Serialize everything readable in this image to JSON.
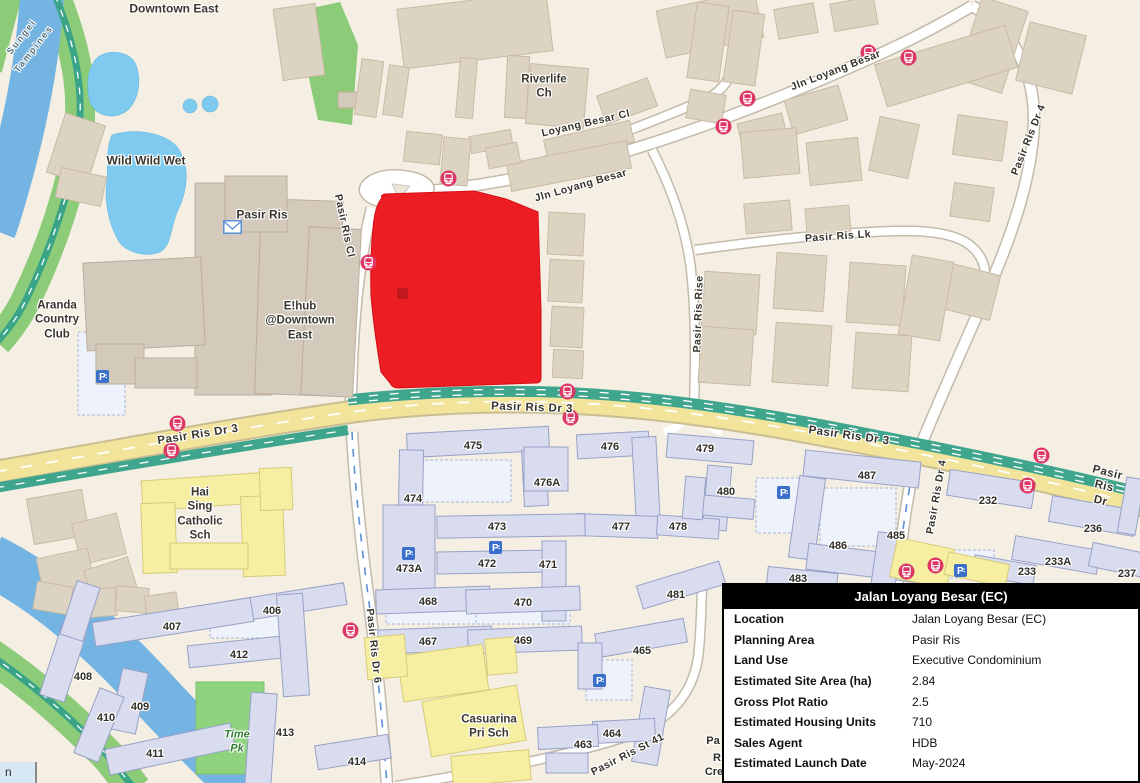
{
  "info_panel": {
    "title": "Jalan Loyang Besar (EC)",
    "rows": [
      {
        "label": "Location",
        "value": "Jalan Loyang Besar (EC)"
      },
      {
        "label": "Planning Area",
        "value": "Pasir Ris"
      },
      {
        "label": "Land Use",
        "value": "Executive Condominium"
      },
      {
        "label": "Estimated Site Area (ha)",
        "value": "2.84"
      },
      {
        "label": "Gross Plot Ratio",
        "value": "2.5"
      },
      {
        "label": "Estimated Housing Units",
        "value": "710"
      },
      {
        "label": "Sales Agent",
        "value": "HDB"
      },
      {
        "label": "Estimated Launch Date",
        "value": "May-2024"
      }
    ]
  },
  "map": {
    "attribution_fragment": "n",
    "colors": {
      "highlight_plot": "#ec1d23",
      "road_major": "#f3e49b",
      "cycle_path": "#3fa58d",
      "water": "#74b4e3",
      "park": "#8ccb77",
      "hdb_block": "#d8dcee",
      "school": "#f6efa2",
      "bus_icon": "#dd3766",
      "parking_icon": "#3a70c9"
    },
    "labels": [
      {
        "text": "Downtown East",
        "x": 174,
        "y": 9,
        "rot": 0,
        "cls": "place"
      },
      {
        "text": "Sungei",
        "x": 22,
        "y": 37,
        "rot": -52,
        "cls": "water",
        "size": 9
      },
      {
        "text": "Tampines",
        "x": 34,
        "y": 49,
        "rot": -52,
        "cls": "water",
        "size": 9
      },
      {
        "text": "Wild Wild Wet",
        "x": 146,
        "y": 161,
        "rot": 0,
        "cls": "place"
      },
      {
        "text": "Pasir Ris",
        "x": 262,
        "y": 215,
        "rot": 0,
        "cls": "place"
      },
      {
        "text": "Aranda\nCountry\nClub",
        "x": 57,
        "y": 320,
        "rot": 0,
        "cls": "place",
        "size": 11.5
      },
      {
        "text": "E!hub\n@Downtown\nEast",
        "x": 300,
        "y": 321,
        "rot": 0,
        "cls": "place",
        "size": 11.5
      },
      {
        "text": "Riverlife\nCh",
        "x": 544,
        "y": 87,
        "rot": 0,
        "cls": "place",
        "size": 11.5
      },
      {
        "text": "Hai\nSing\nCatholic\nSch",
        "x": 200,
        "y": 514,
        "rot": 0,
        "cls": "place",
        "size": 11.5
      },
      {
        "text": "Casuarina\nPri Sch",
        "x": 489,
        "y": 727,
        "rot": 0,
        "cls": "place",
        "size": 11.5
      },
      {
        "text": "Time\nPk",
        "x": 237,
        "y": 742,
        "rot": 0,
        "cls": "park",
        "size": 11
      },
      {
        "text": "Loyang Besar Cl",
        "x": 586,
        "y": 124,
        "rot": -13,
        "cls": "street"
      },
      {
        "text": "Jln Loyang Besar",
        "x": 581,
        "y": 186,
        "rot": -16,
        "cls": "street"
      },
      {
        "text": "Jln Loyang Besar",
        "x": 836,
        "y": 71,
        "rot": -21,
        "cls": "street"
      },
      {
        "text": "Pasir Ris Lk",
        "x": 838,
        "y": 237,
        "rot": -4,
        "cls": "street"
      },
      {
        "text": "Pasir Ris Rise",
        "x": 699,
        "y": 314,
        "rot": -88,
        "cls": "street"
      },
      {
        "text": "Pasir Ris Dr 4",
        "x": 1029,
        "y": 140,
        "rot": -68,
        "cls": "street"
      },
      {
        "text": "Pasir Ris Dr 4",
        "x": 937,
        "y": 497,
        "rot": -80,
        "cls": "street"
      },
      {
        "text": "Pasir Ris Cl",
        "x": 344,
        "y": 226,
        "rot": 78,
        "cls": "street"
      },
      {
        "text": "Pasir Ris Dr 3",
        "x": 198,
        "y": 435,
        "rot": -9,
        "cls": "street",
        "size": 11.5
      },
      {
        "text": "Pasir Ris Dr 3",
        "x": 532,
        "y": 408,
        "rot": 2,
        "cls": "street",
        "size": 11.5
      },
      {
        "text": "Pasir Ris Dr 3",
        "x": 849,
        "y": 436,
        "rot": 8,
        "cls": "street",
        "size": 11.5
      },
      {
        "text": "Pasir Ris Dr",
        "x": 1104,
        "y": 487,
        "rot": 14,
        "cls": "street",
        "size": 11.5
      },
      {
        "text": "Pasir Ris Dr 6",
        "x": 373,
        "y": 646,
        "rot": 84,
        "cls": "street"
      },
      {
        "text": "Pasir Ris St 41",
        "x": 628,
        "y": 755,
        "rot": -27,
        "cls": "street"
      },
      {
        "text": "475",
        "x": 473,
        "y": 447,
        "cls": "block"
      },
      {
        "text": "476",
        "x": 610,
        "y": 448,
        "cls": "block"
      },
      {
        "text": "479",
        "x": 705,
        "y": 450,
        "cls": "block"
      },
      {
        "text": "474",
        "x": 413,
        "y": 500,
        "cls": "block"
      },
      {
        "text": "476A",
        "x": 547,
        "y": 484,
        "cls": "block"
      },
      {
        "text": "473",
        "x": 497,
        "y": 528,
        "cls": "block"
      },
      {
        "text": "477",
        "x": 621,
        "y": 528,
        "cls": "block"
      },
      {
        "text": "478",
        "x": 678,
        "y": 528,
        "cls": "block"
      },
      {
        "text": "480",
        "x": 726,
        "y": 493,
        "cls": "block"
      },
      {
        "text": "487",
        "x": 867,
        "y": 477,
        "cls": "block"
      },
      {
        "text": "473A",
        "x": 409,
        "y": 570,
        "cls": "block"
      },
      {
        "text": "472",
        "x": 487,
        "y": 565,
        "cls": "block"
      },
      {
        "text": "471",
        "x": 548,
        "y": 566,
        "cls": "block"
      },
      {
        "text": "486",
        "x": 838,
        "y": 547,
        "cls": "block"
      },
      {
        "text": "485",
        "x": 896,
        "y": 537,
        "cls": "block"
      },
      {
        "text": "232",
        "x": 988,
        "y": 502,
        "cls": "block"
      },
      {
        "text": "236",
        "x": 1093,
        "y": 530,
        "cls": "block"
      },
      {
        "text": "233A",
        "x": 1058,
        "y": 563,
        "cls": "block"
      },
      {
        "text": "233",
        "x": 1027,
        "y": 573,
        "cls": "block"
      },
      {
        "text": "237",
        "x": 1127,
        "y": 575,
        "cls": "block"
      },
      {
        "text": "483",
        "x": 798,
        "y": 580,
        "cls": "block"
      },
      {
        "text": "468",
        "x": 428,
        "y": 603,
        "cls": "block"
      },
      {
        "text": "470",
        "x": 523,
        "y": 604,
        "cls": "block"
      },
      {
        "text": "481",
        "x": 676,
        "y": 596,
        "cls": "block"
      },
      {
        "text": "467",
        "x": 428,
        "y": 643,
        "cls": "block"
      },
      {
        "text": "469",
        "x": 523,
        "y": 642,
        "cls": "block"
      },
      {
        "text": "465",
        "x": 642,
        "y": 652,
        "cls": "block"
      },
      {
        "text": "406",
        "x": 272,
        "y": 612,
        "cls": "block"
      },
      {
        "text": "407",
        "x": 172,
        "y": 628,
        "cls": "block"
      },
      {
        "text": "412",
        "x": 239,
        "y": 656,
        "cls": "block"
      },
      {
        "text": "408",
        "x": 83,
        "y": 678,
        "cls": "block"
      },
      {
        "text": "409",
        "x": 140,
        "y": 708,
        "cls": "block"
      },
      {
        "text": "410",
        "x": 106,
        "y": 719,
        "cls": "block"
      },
      {
        "text": "411",
        "x": 155,
        "y": 755,
        "cls": "block"
      },
      {
        "text": "413",
        "x": 285,
        "y": 734,
        "cls": "block"
      },
      {
        "text": "414",
        "x": 357,
        "y": 763,
        "cls": "block"
      },
      {
        "text": "464",
        "x": 612,
        "y": 735,
        "cls": "block"
      },
      {
        "text": "463",
        "x": 583,
        "y": 746,
        "cls": "block"
      },
      {
        "text": "Pa",
        "x": 713,
        "y": 742,
        "cls": "block"
      },
      {
        "text": "R",
        "x": 717,
        "y": 759,
        "cls": "block"
      },
      {
        "text": "Cre",
        "x": 714,
        "y": 773,
        "cls": "block"
      }
    ],
    "icons": [
      {
        "type": "bus",
        "x": 448,
        "y": 178
      },
      {
        "type": "bus",
        "x": 368,
        "y": 262
      },
      {
        "type": "bus",
        "x": 868,
        "y": 52
      },
      {
        "type": "bus",
        "x": 908,
        "y": 57
      },
      {
        "type": "bus",
        "x": 747,
        "y": 98
      },
      {
        "type": "bus",
        "x": 723,
        "y": 126
      },
      {
        "type": "bus",
        "x": 567,
        "y": 391
      },
      {
        "type": "bus",
        "x": 570,
        "y": 417
      },
      {
        "type": "bus",
        "x": 177,
        "y": 423
      },
      {
        "type": "bus",
        "x": 171,
        "y": 450
      },
      {
        "type": "bus",
        "x": 350,
        "y": 630
      },
      {
        "type": "bus",
        "x": 1041,
        "y": 455
      },
      {
        "type": "bus",
        "x": 1027,
        "y": 485
      },
      {
        "type": "bus",
        "x": 906,
        "y": 571
      },
      {
        "type": "bus",
        "x": 935,
        "y": 565
      },
      {
        "type": "parking",
        "x": 102,
        "y": 376
      },
      {
        "type": "parking",
        "x": 408,
        "y": 553
      },
      {
        "type": "parking",
        "x": 495,
        "y": 547
      },
      {
        "type": "parking",
        "x": 783,
        "y": 492
      },
      {
        "type": "parking",
        "x": 960,
        "y": 570
      },
      {
        "type": "parking",
        "x": 599,
        "y": 680
      },
      {
        "type": "post",
        "x": 232,
        "y": 227
      }
    ]
  }
}
